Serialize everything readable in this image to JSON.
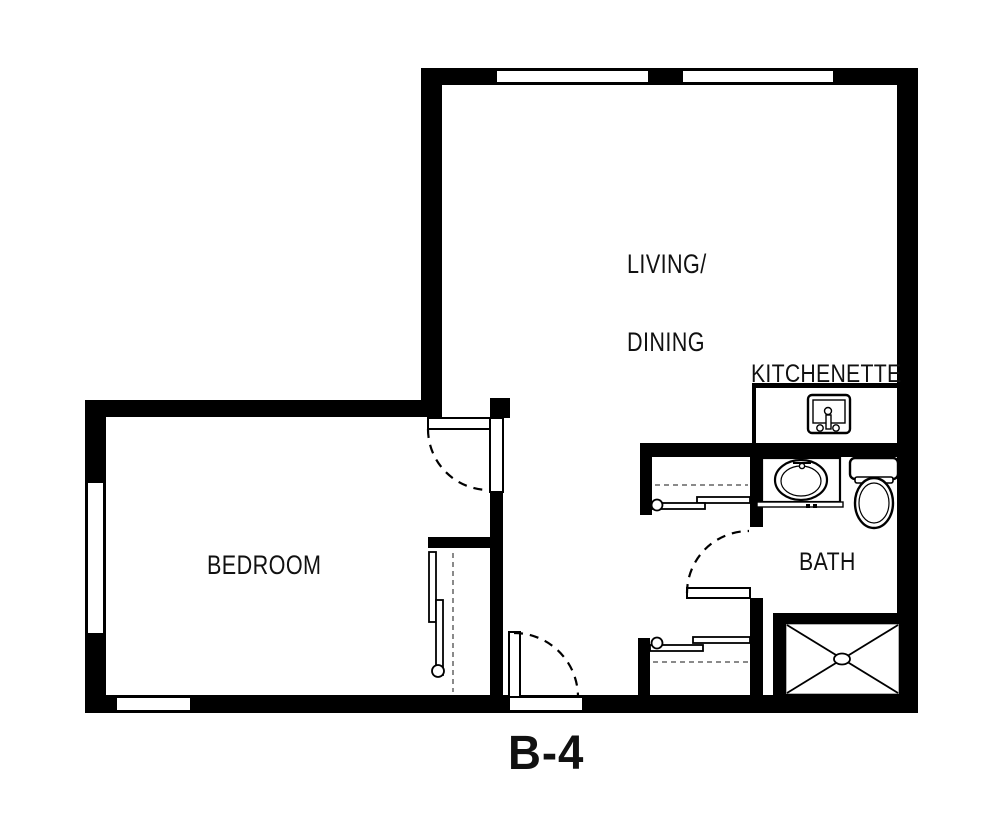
{
  "title": "B-4",
  "rooms": {
    "living_dining": {
      "line1": "LIVING/",
      "line2": "DINING"
    },
    "bedroom": {
      "label": "BEDROOM"
    },
    "kitchenette": {
      "label": "KITCHENETTE"
    },
    "bath": {
      "label": "BATH"
    }
  },
  "fixtures": {
    "kitchenette_sink": "kitchenette-sink",
    "bathroom_sink": "bathroom-sink",
    "toilet": "toilet",
    "shower": "shower"
  },
  "colors": {
    "wall": "#000000",
    "floor": "#ffffff",
    "shelf_dash": "#8a8a8a"
  }
}
